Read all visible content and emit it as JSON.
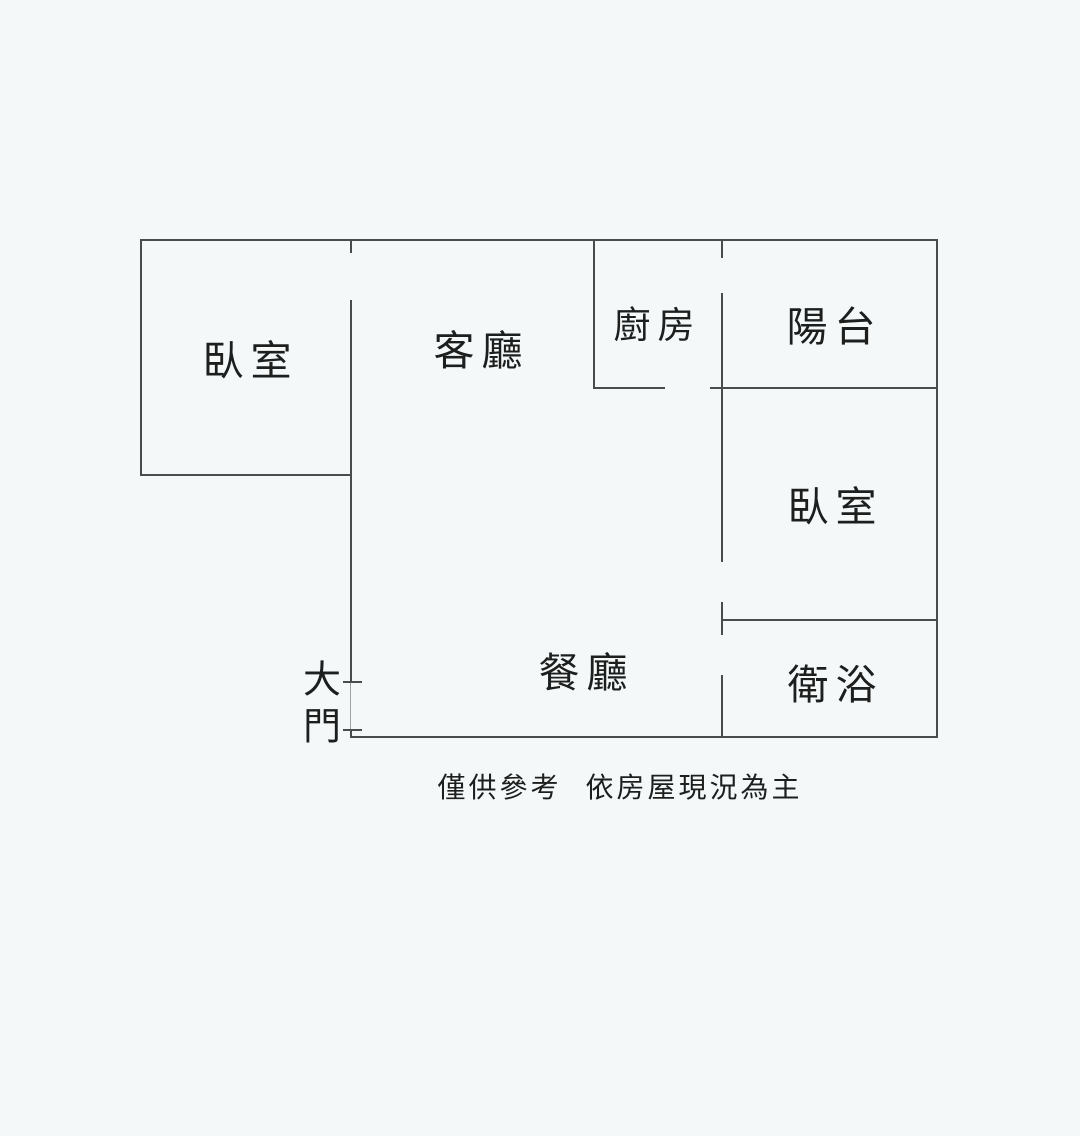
{
  "diagram": {
    "type": "floor-plan",
    "rooms": [
      {
        "id": "bedroom-left",
        "label": "臥室"
      },
      {
        "id": "living-room",
        "label": "客廳"
      },
      {
        "id": "kitchen",
        "label": "廚房"
      },
      {
        "id": "balcony",
        "label": "陽台"
      },
      {
        "id": "bedroom-right",
        "label": "臥室"
      },
      {
        "id": "dining-room",
        "label": "餐廳"
      },
      {
        "id": "bathroom",
        "label": "衛浴"
      }
    ],
    "entrance": {
      "label": "大門",
      "chars": [
        "大",
        "門"
      ]
    },
    "caption": "僅供參考 依房屋現況為主"
  },
  "colors": {
    "background": "#f5f8f8",
    "wall": "#474c4c",
    "wall_light": "#9aa2a2",
    "text": "#1d1f1f"
  }
}
